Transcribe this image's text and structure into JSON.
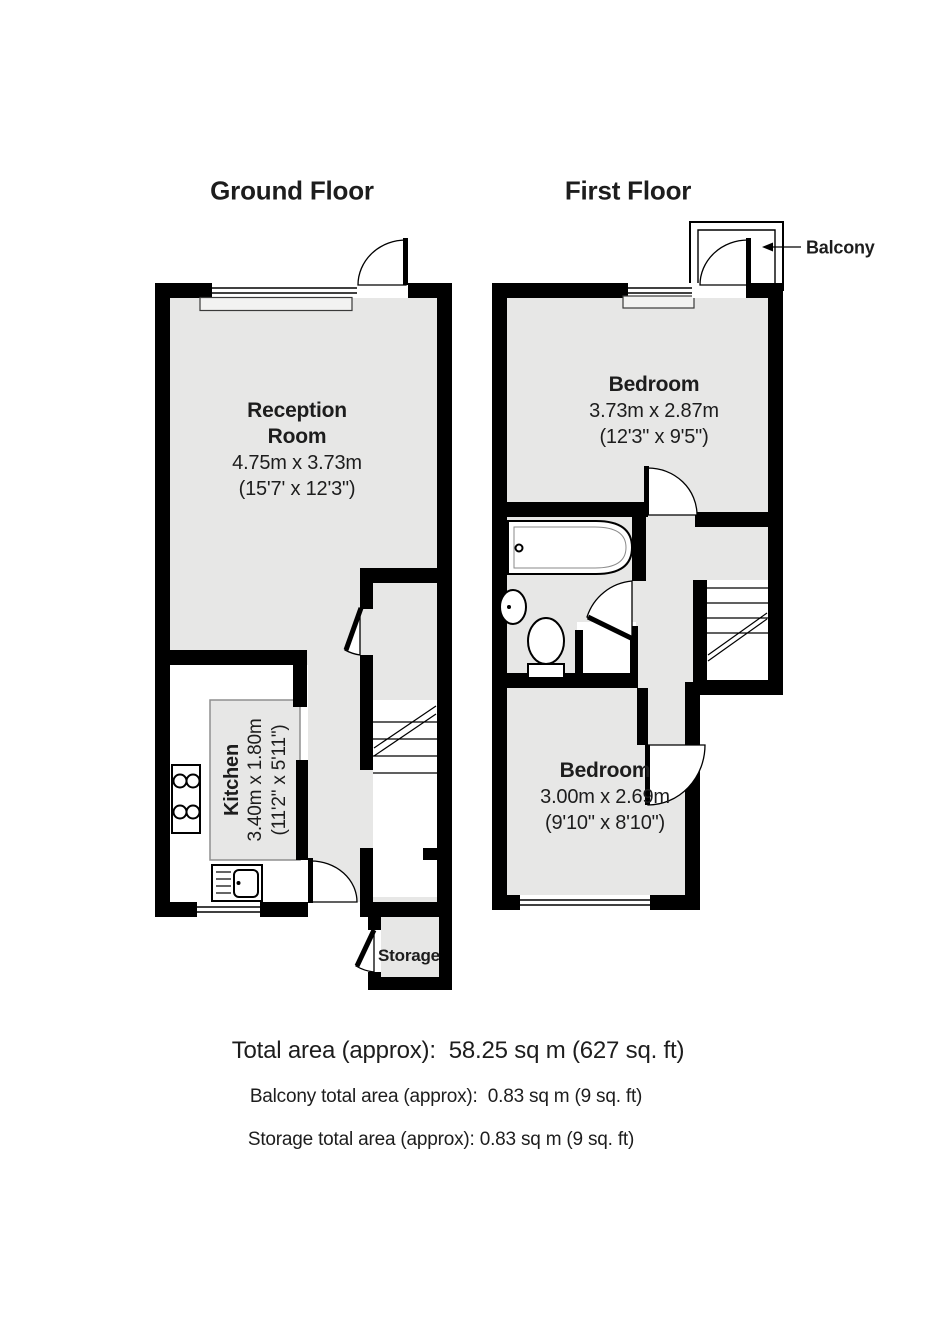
{
  "colors": {
    "wall": "#000000",
    "room": "#e7e7e6",
    "text": "#1d1d1d",
    "kboxborder": "#8f8f8f"
  },
  "ground_floor": {
    "title": "Ground Floor",
    "reception": {
      "name_line1": "Reception",
      "name_line2": "Room",
      "metric": "4.75m x 3.73m",
      "imperial": "(15'7' x 12'3\")"
    },
    "kitchen": {
      "name": "Kitchen",
      "metric": "3.40m x 1.80m",
      "imperial": "(11'2\" x 5'11\")"
    },
    "storage_label": "Storage"
  },
  "first_floor": {
    "title": "First Floor",
    "balcony_label": "Balcony",
    "bedroom_front": {
      "name": "Bedroom",
      "metric": "3.73m x 2.87m",
      "imperial": "(12'3\" x 9'5\")"
    },
    "bedroom_back": {
      "name": "Bedroom",
      "metric": "3.00m x 2.69m",
      "imperial": "(9'10\" x 8'10\")"
    }
  },
  "summary": {
    "total": "Total area (approx):  58.25 sq m (627 sq. ft)",
    "balcony": "Balcony total area (approx):  0.83 sq m (9 sq. ft)",
    "storage": "Storage total area (approx): 0.83 sq m (9 sq. ft)"
  }
}
